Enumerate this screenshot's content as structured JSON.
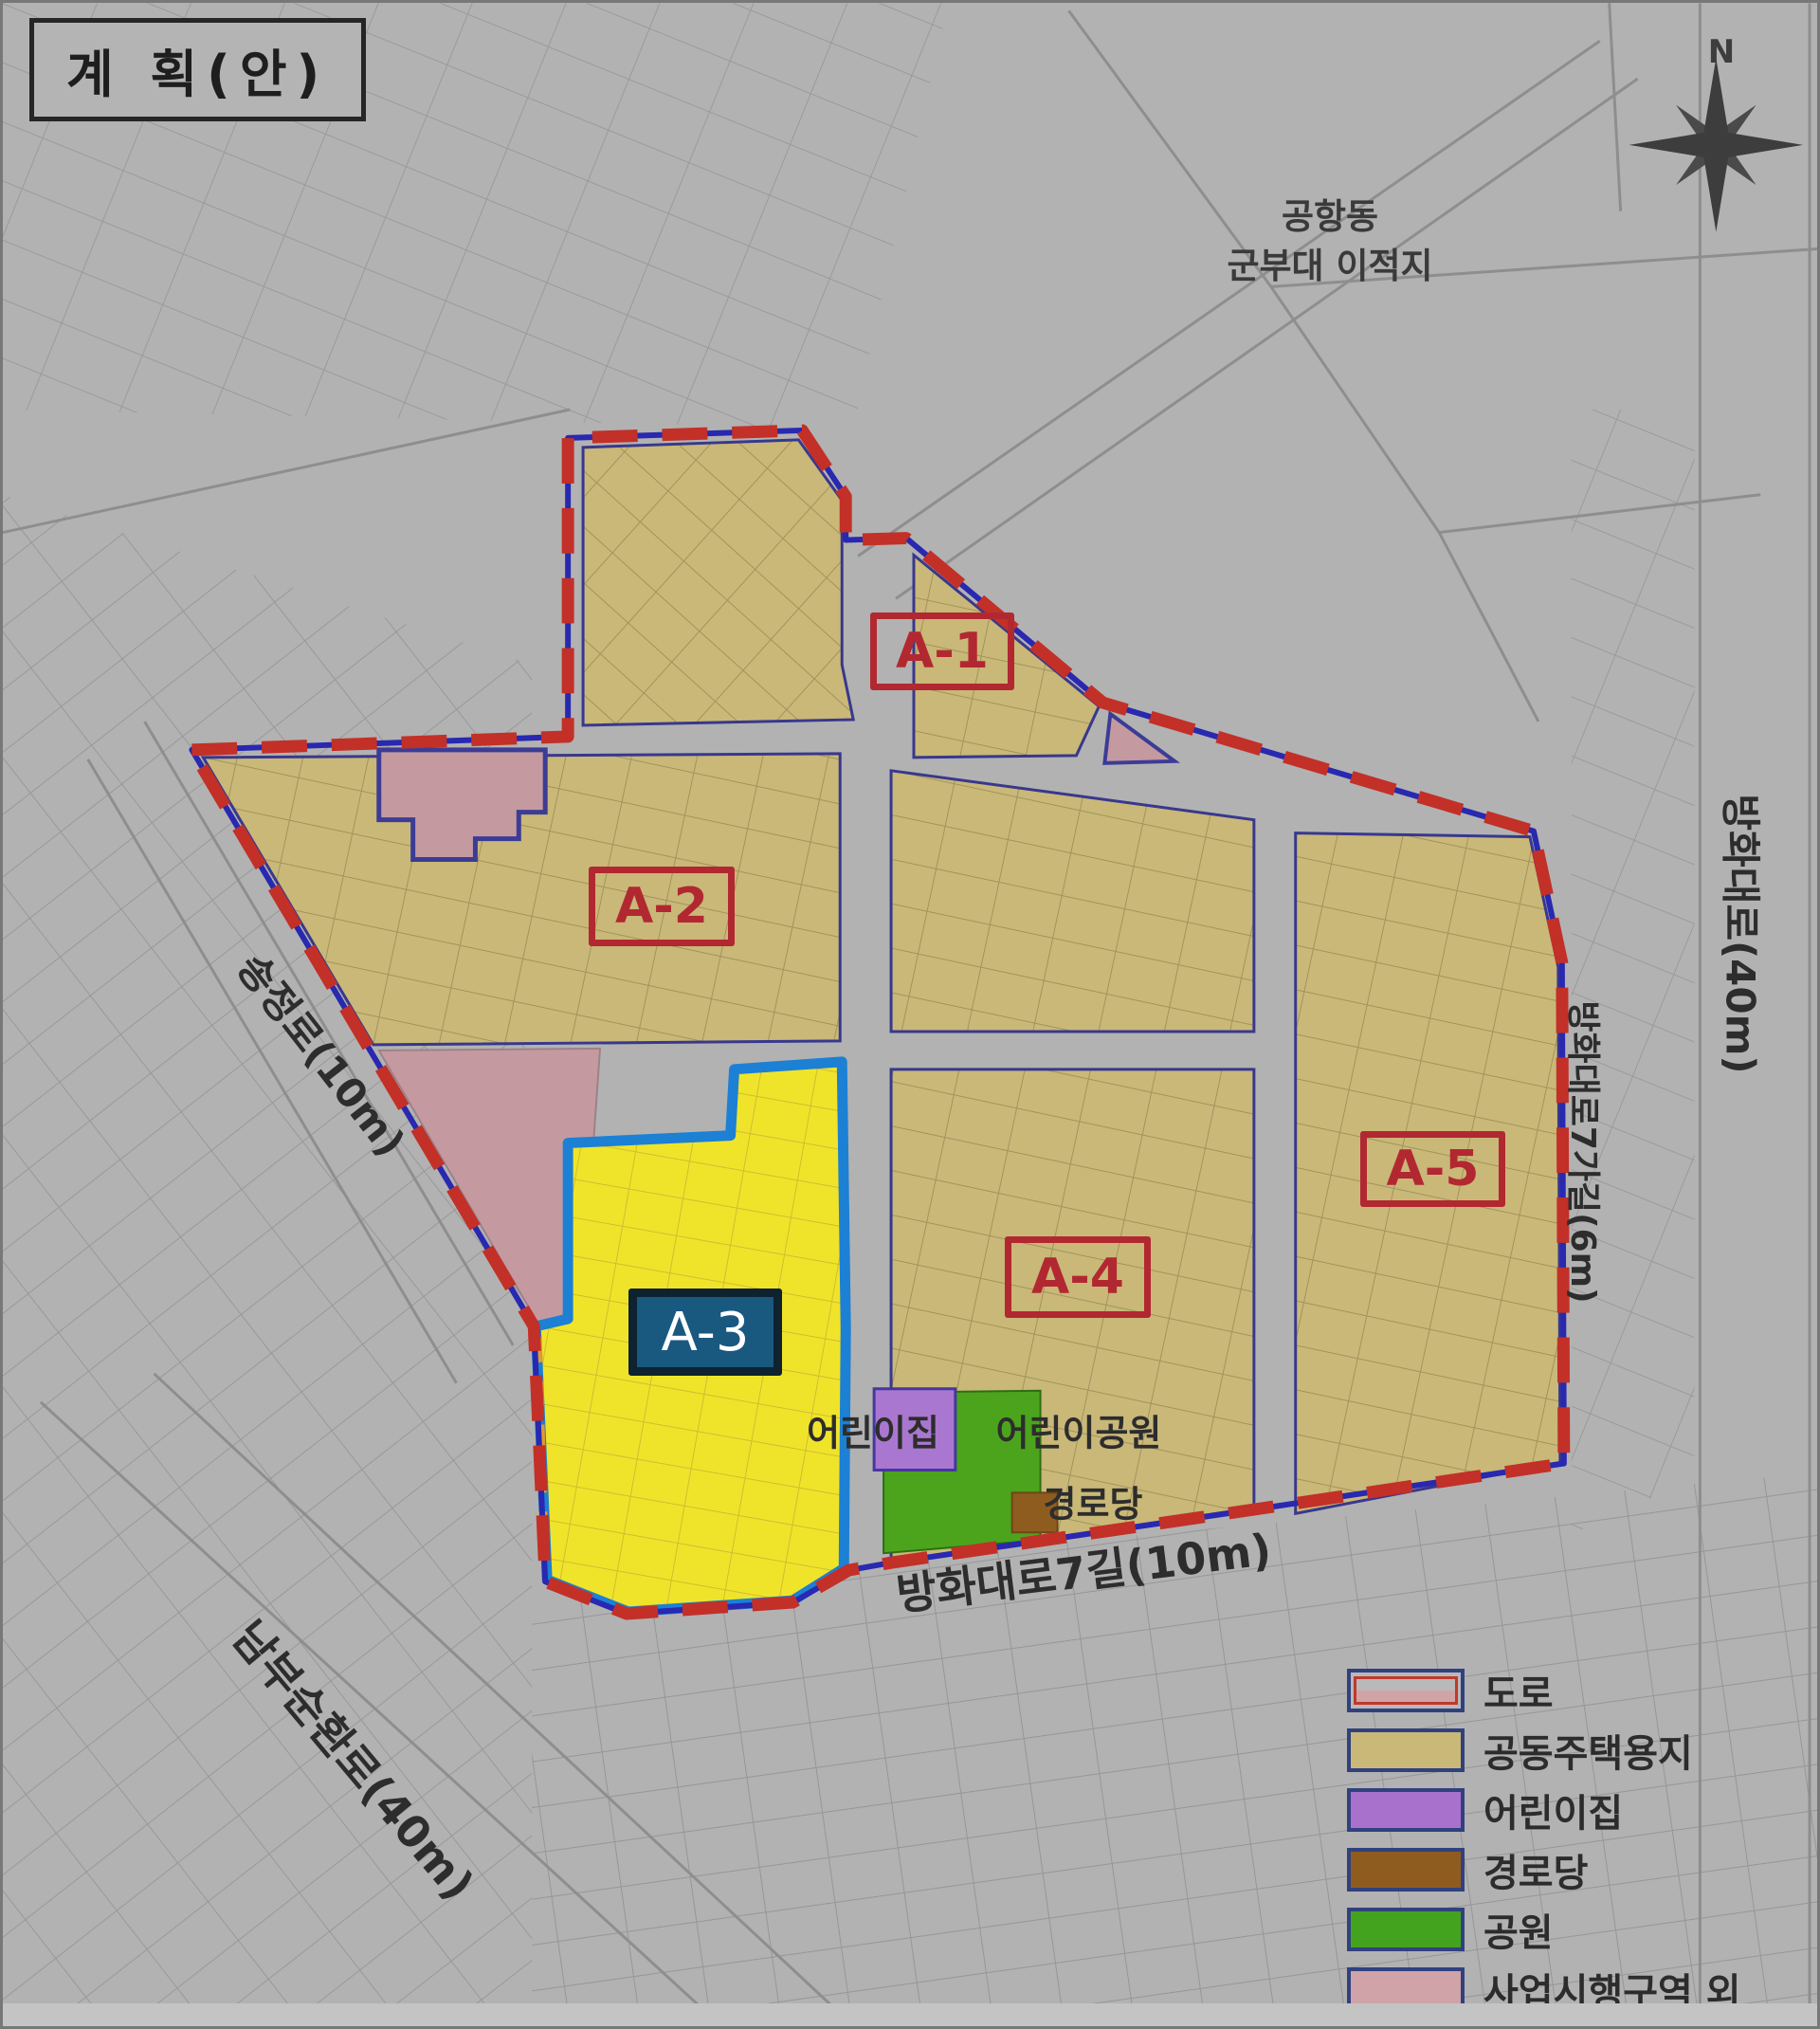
{
  "title": "계 획(안)",
  "compass": {
    "north_label": "N"
  },
  "annotations": {
    "airport_line1": "공항동",
    "airport_line2": "군부대 이적지",
    "daycare": "어린이집",
    "childrens_park": "어린이공원",
    "senior_center": "경로당"
  },
  "roads": {
    "songjeong": "송정로(10m)",
    "banghwa_daero": "방화대로(40m)",
    "banghwa_7gagil": "방화대로7가길(6m)",
    "banghwa_7gil": "방화대로7길(10m)",
    "nambu_sunhwanro": "남부순환로(40m)"
  },
  "districts": [
    {
      "id": "A-1",
      "label": "A-1",
      "highlighted": false
    },
    {
      "id": "A-2",
      "label": "A-2",
      "highlighted": false
    },
    {
      "id": "A-3",
      "label": "A-3",
      "highlighted": true
    },
    {
      "id": "A-4",
      "label": "A-4",
      "highlighted": false
    },
    {
      "id": "A-5",
      "label": "A-5",
      "highlighted": false
    }
  ],
  "legend": {
    "items": [
      {
        "label": "도로",
        "fill": "#b9b9b9",
        "stripe": "#c0392b"
      },
      {
        "label": "공동주택용지",
        "fill": "#c9b878"
      },
      {
        "label": "어린이집",
        "fill": "#a872cc"
      },
      {
        "label": "경로당",
        "fill": "#8f5c20"
      },
      {
        "label": "공원",
        "fill": "#44a31e"
      },
      {
        "label": "사업시행구역 외",
        "fill": "#cfa3a8"
      }
    ]
  },
  "colors": {
    "boundary_red": "#c23028",
    "boundary_blue": "#2828b0",
    "housing_tan": "#c9b878",
    "highlight_yellow": "#f0e42a",
    "highlight_outline_blue": "#1c80d4",
    "road_edge_navy": "#38388e",
    "outside_pink": "#c49aa0",
    "park_green": "#4ca41d",
    "daycare_purple": "#aa77d0",
    "senior_brown": "#8f5c20",
    "district_label_red": "#b22831",
    "a3_box_bg": "#19597f",
    "background_gray": "#b2b2b2"
  }
}
